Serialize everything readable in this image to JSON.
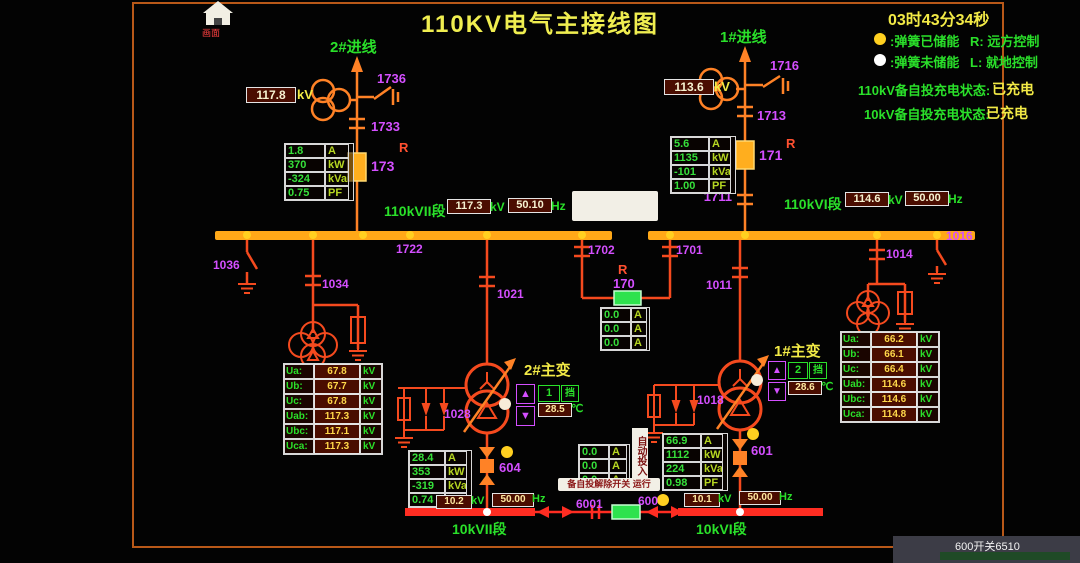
{
  "header": {
    "title": "110KV电气主接线图",
    "clock": "03时43分34秒",
    "home_label": "画面"
  },
  "legend": {
    "stored_text": ":弹簧已储能",
    "remote_text": "R: 远方控制",
    "unstored_text": ":弹簧未储能",
    "local_text": "L: 就地控制"
  },
  "status": {
    "label_110": "110kV备自投充电状态:",
    "value_110": "已充电",
    "label_10": "10kV备自投充电状态:",
    "value_10": "已充电"
  },
  "incoming2": {
    "name": "2#进线",
    "kv": "117.8",
    "kv_unit": "kV",
    "sw_top": "1736",
    "sw_mid": "1733",
    "remote": "R",
    "breaker": "173",
    "meter": [
      [
        "1.8",
        "A"
      ],
      [
        "370",
        "kW"
      ],
      [
        "-324",
        "kVar"
      ],
      [
        "0.75",
        "PF"
      ]
    ]
  },
  "incoming1": {
    "name": "1#进线",
    "kv": "113.6",
    "kv_unit": "kV",
    "sw_top": "1716",
    "sw_mid": "1713",
    "remote": "R",
    "breaker": "171",
    "sw_low": "1711",
    "meter": [
      [
        "5.6",
        "A"
      ],
      [
        "1135",
        "kW"
      ],
      [
        "-101",
        "kVar"
      ],
      [
        "1.00",
        "PF"
      ]
    ]
  },
  "bus2": {
    "name": "110kVII段",
    "kv": "117.3",
    "kv_unit": "kV",
    "hz": "50.10",
    "hz_unit": "Hz",
    "junction": "1722"
  },
  "bus1": {
    "name": "110kVI段",
    "kv": "114.6",
    "kv_unit": "kV",
    "hz": "50.00",
    "hz_unit": "Hz"
  },
  "bridge": {
    "sw_left": "1702",
    "sw_right": "1701",
    "remote": "R",
    "breaker": "170",
    "meter": [
      [
        "0.0",
        "A"
      ],
      [
        "0.0",
        "A"
      ],
      [
        "0.0",
        "A"
      ]
    ]
  },
  "pt_bus2": {
    "ground_sw": "1036",
    "sw": "1034"
  },
  "pt_bus1": {
    "sw": "1014",
    "ground_sw": "1016"
  },
  "panel_bus2": {
    "rows": [
      [
        "Ua:",
        "67.8",
        "kV"
      ],
      [
        "Ub:",
        "67.7",
        "kV"
      ],
      [
        "Uc:",
        "67.8",
        "kV"
      ],
      [
        "Uab:",
        "117.3",
        "kV"
      ],
      [
        "Ubc:",
        "117.1",
        "kV"
      ],
      [
        "Uca:",
        "117.3",
        "kV"
      ]
    ]
  },
  "panel_bus1": {
    "rows": [
      [
        "Ua:",
        "66.2",
        "kV"
      ],
      [
        "Ub:",
        "66.1",
        "kV"
      ],
      [
        "Uc:",
        "66.4",
        "kV"
      ],
      [
        "Uab:",
        "114.6",
        "kV"
      ],
      [
        "Ubc:",
        "114.6",
        "kV"
      ],
      [
        "Uca:",
        "114.8",
        "kV"
      ]
    ]
  },
  "tx2": {
    "name": "2#主变",
    "sw": "1021",
    "arrester": "1028",
    "tap": "1",
    "tap_unit": "挡",
    "temp": "28.5",
    "temp_unit": "℃",
    "breaker": "604",
    "meter": [
      [
        "28.4",
        "A"
      ],
      [
        "353",
        "kW"
      ],
      [
        "-319",
        "kVar"
      ],
      [
        "0.74",
        "PF"
      ]
    ]
  },
  "tx1": {
    "name": "1#主变",
    "sw": "1011",
    "arrester": "1018",
    "tap": "2",
    "tap_unit": "挡",
    "temp": "28.6",
    "temp_unit": "℃",
    "breaker": "601",
    "meter": [
      [
        "66.9",
        "A"
      ],
      [
        "1112",
        "kW"
      ],
      [
        "224",
        "kVar"
      ],
      [
        "0.98",
        "PF"
      ]
    ]
  },
  "bus10_left": {
    "name": "10kVII段",
    "kv": "10.2",
    "kv_unit": "kV",
    "hz": "50.00",
    "hz_unit": "Hz"
  },
  "bus10_right": {
    "name": "10kVI段",
    "kv": "10.1",
    "kv_unit": "kV",
    "hz": "50.00",
    "hz_unit": "Hz"
  },
  "tie10": {
    "sw": "6001",
    "breaker": "600",
    "meter": [
      [
        "0.0",
        "A"
      ],
      [
        "0.0",
        "A"
      ],
      [
        "0.0",
        "A"
      ]
    ],
    "vertical_tag": "自动投入",
    "tag": "备自投解除开关 运行"
  },
  "taskbar": {
    "text": "600开关6510"
  }
}
